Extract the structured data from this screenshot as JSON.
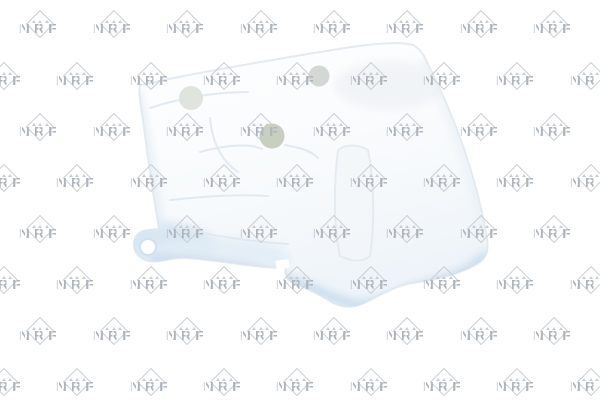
{
  "page": {
    "background_color": "#ffffff",
    "width_px": 600,
    "height_px": 400
  },
  "watermark": {
    "text": "NRF",
    "text_color": "#aeb4bb",
    "outline_color": "#c9cdd2",
    "layout": {
      "row_y_centers": [
        25,
        77,
        128,
        179,
        230,
        281,
        332,
        383
      ],
      "even_row_x_centers": [
        40,
        113.5,
        187,
        260.5,
        334,
        407,
        480.5,
        554
      ],
      "odd_row_x_centers": [
        3.5,
        77,
        150.5,
        224,
        297,
        370.5,
        444,
        517,
        590.5
      ]
    }
  },
  "product": {
    "description": "white plastic expansion tank photo",
    "colors": {
      "body_highlight": "#ffffff",
      "body_base": "#f6f9fc",
      "body_shadow": "#d7e4f0",
      "edge_line": "#e4eaef",
      "top_recess_circle": "#dfe4df",
      "center_hole_circle": "#c7cfc1",
      "filler_recess_circle": "#d3d8d5",
      "seam_line": "#dfe8f0"
    }
  }
}
